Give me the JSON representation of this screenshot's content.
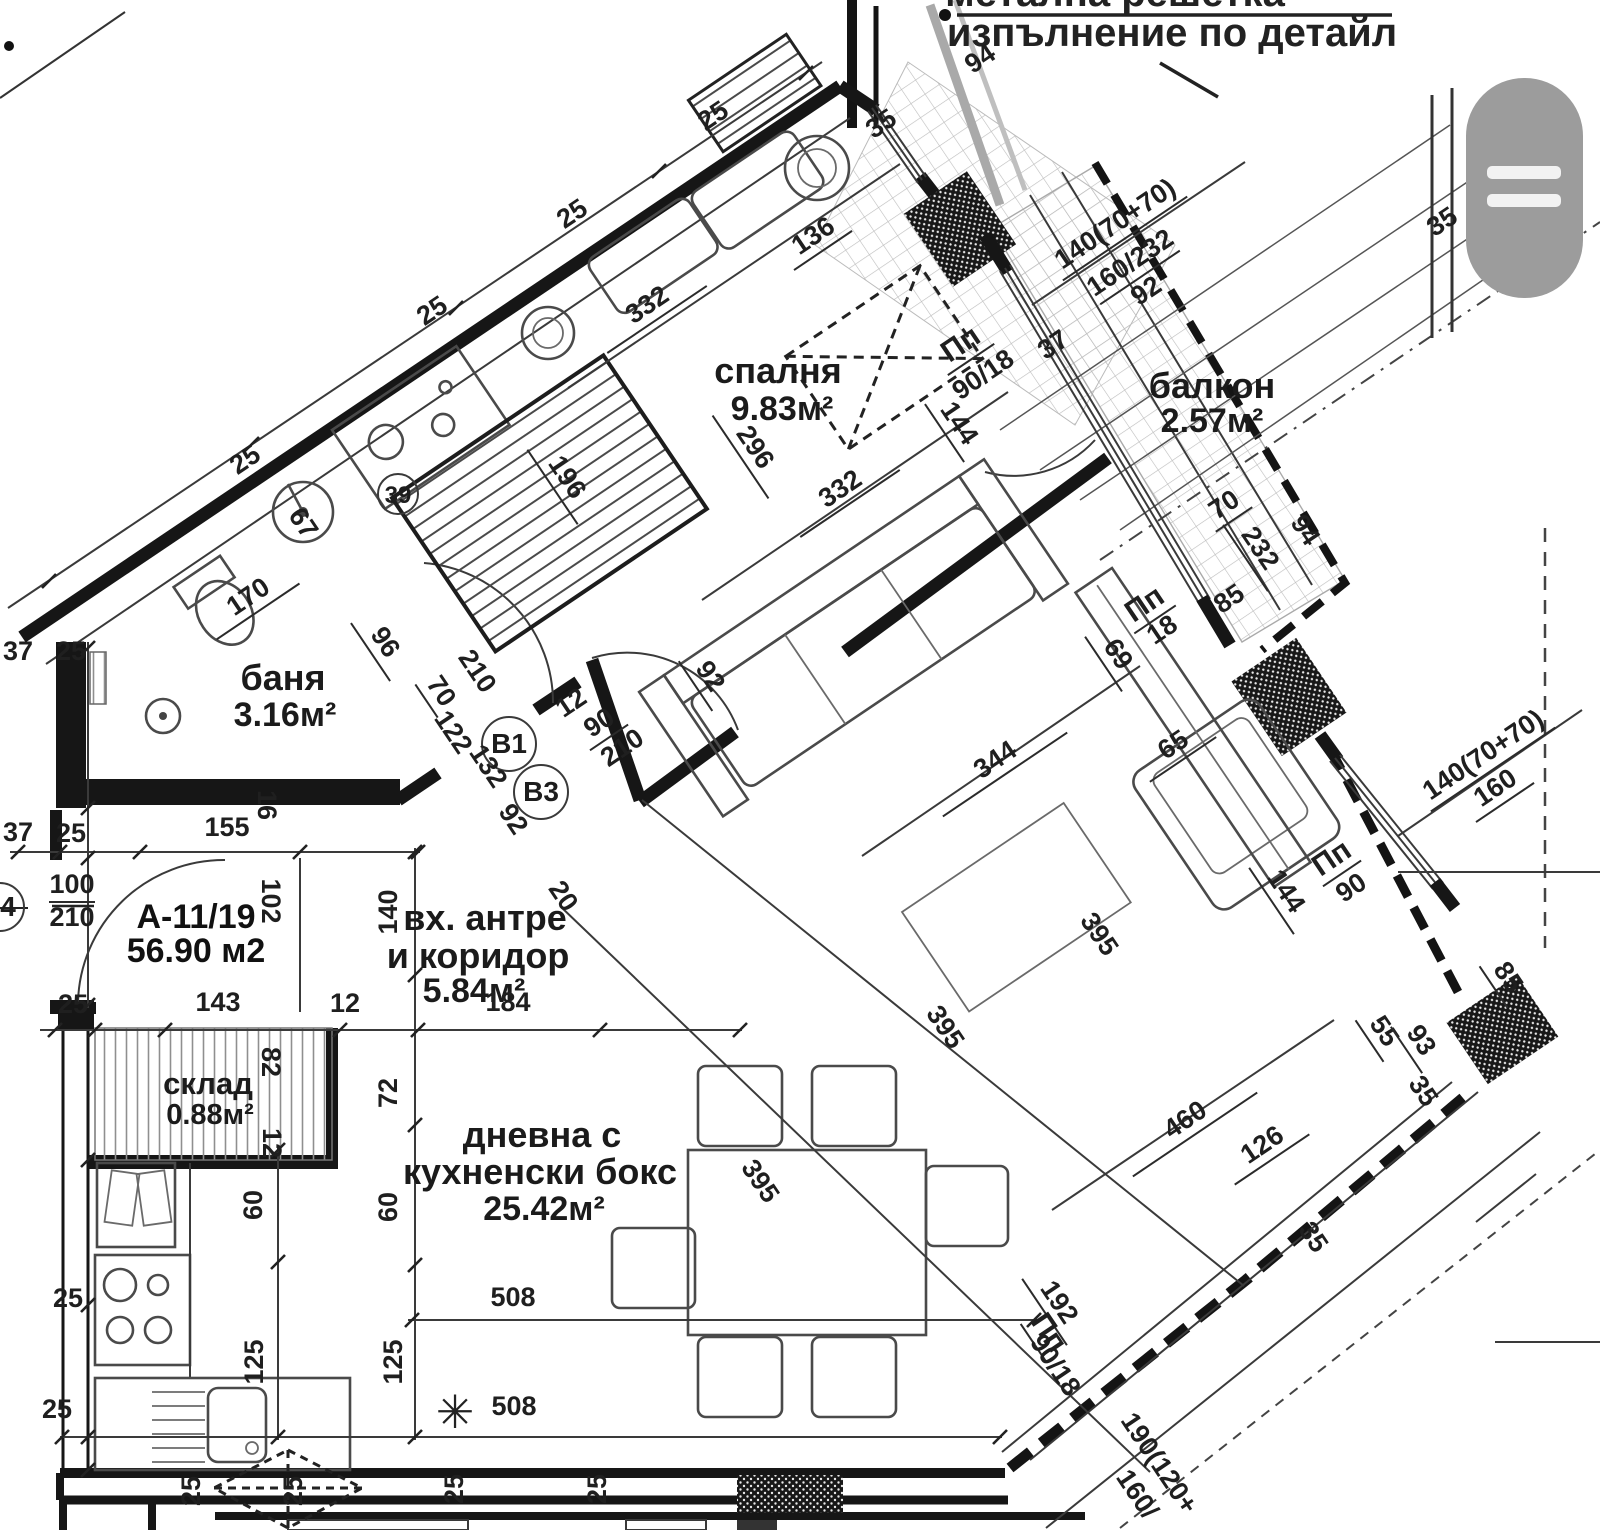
{
  "annotation": {
    "line1": "метална решетка",
    "line2": "изпълнение по детайл"
  },
  "apartment": {
    "id": "А-11/19",
    "area_label": "56.90 м2"
  },
  "rooms": [
    {
      "name": "спалня",
      "area": "9.83м²"
    },
    {
      "name": "балкон",
      "area": "2.57м²"
    },
    {
      "name": "баня",
      "area": "3.16м²"
    },
    {
      "name": "вх. антре",
      "name2": "и коридор",
      "area": "5.84м²"
    },
    {
      "name": "склад",
      "area": "0.88м²"
    },
    {
      "name": "дневна с",
      "name2": "кухненски бокс",
      "area": "25.42м²"
    }
  ],
  "markers": [
    {
      "t": "В1"
    },
    {
      "t": "В3"
    },
    {
      "t": "4"
    },
    {
      "t": "39"
    }
  ],
  "symbols": {
    "asterisk": "✳",
    "menu_icon": "hamburger-menu-icon"
  },
  "colors": {
    "line": "#1b1b1b",
    "menu_gray": "#9c9c9c",
    "paper": "#ffffff"
  },
  "labels": [
    {
      "t": "94",
      "x": 985,
      "y": 66,
      "r": -34
    },
    {
      "t": "25",
      "x": 718,
      "y": 123,
      "r": -34
    },
    {
      "t": "25",
      "x": 577,
      "y": 221,
      "r": -34
    },
    {
      "t": "25",
      "x": 437,
      "y": 318,
      "r": -34
    },
    {
      "t": "25",
      "x": 250,
      "y": 467,
      "r": -34
    },
    {
      "t": "35",
      "x": 886,
      "y": 131,
      "r": -34
    },
    {
      "t": "136",
      "x": 818,
      "y": 243,
      "r": -34,
      "ln": 70
    },
    {
      "t": "332",
      "x": 652,
      "y": 312,
      "r": -34,
      "ln": 120
    },
    {
      "t": "332",
      "x": 845,
      "y": 496,
      "r": -34,
      "ln": 120
    },
    {
      "t": "296",
      "x": 748,
      "y": 452,
      "r": 56,
      "ln": 100
    },
    {
      "t": "196",
      "x": 560,
      "y": 482,
      "r": 56,
      "ln": 90
    },
    {
      "t": "144",
      "x": 952,
      "y": 428,
      "r": 56,
      "ln": 70
    },
    {
      "t": "Пп",
      "x": 966,
      "y": 352,
      "r": -34,
      "fs": 30,
      "ln": 56
    },
    {
      "t": "90/18",
      "x": 988,
      "y": 382,
      "r": -34
    },
    {
      "t": "35",
      "x": 1447,
      "y": 229,
      "r": -34
    },
    {
      "t": "140(70+70)",
      "x": 1120,
      "y": 231,
      "r": -34,
      "ln": 150
    },
    {
      "t": "160/232",
      "x": 1135,
      "y": 270,
      "r": -34,
      "ln": 96
    },
    {
      "t": "92",
      "x": 1151,
      "y": 298,
      "r": -34
    },
    {
      "t": "37",
      "x": 1058,
      "y": 352,
      "r": -34
    },
    {
      "t": "70",
      "x": 1229,
      "y": 512,
      "r": -34,
      "ln": 44
    },
    {
      "t": "232",
      "x": 1253,
      "y": 553,
      "r": 56,
      "ln": 80
    },
    {
      "t": "94",
      "x": 1298,
      "y": 535,
      "r": 56
    },
    {
      "t": "Пп",
      "x": 1150,
      "y": 612,
      "r": -34,
      "fs": 30,
      "ln": 50
    },
    {
      "t": "18",
      "x": 1167,
      "y": 637,
      "r": -34
    },
    {
      "t": "85",
      "x": 1234,
      "y": 606,
      "r": -34
    },
    {
      "t": "69",
      "x": 1111,
      "y": 659,
      "r": 56,
      "ln": 66
    },
    {
      "t": "344",
      "x": 1000,
      "y": 767,
      "r": -34,
      "ln": 150
    },
    {
      "t": "65",
      "x": 1178,
      "y": 752,
      "r": -34,
      "ln": 80
    },
    {
      "t": "144",
      "x": 1279,
      "y": 896,
      "r": 56,
      "ln": 80
    },
    {
      "t": "Пп",
      "x": 1337,
      "y": 866,
      "r": -34,
      "fs": 30,
      "ln": 46
    },
    {
      "t": "90",
      "x": 1356,
      "y": 895,
      "r": -34
    },
    {
      "t": "140(70+70)",
      "x": 1488,
      "y": 762,
      "r": -34,
      "ln": 150
    },
    {
      "t": "160",
      "x": 1500,
      "y": 795,
      "r": -34,
      "ln": 70
    },
    {
      "t": "85",
      "x": 1501,
      "y": 982,
      "r": 56,
      "ln": 50
    },
    {
      "t": "170",
      "x": 253,
      "y": 604,
      "r": -34,
      "ln": 100
    },
    {
      "t": "96",
      "x": 378,
      "y": 647,
      "r": 56,
      "ln": 70
    },
    {
      "t": "70",
      "x": 434,
      "y": 696,
      "r": 56,
      "ln": 40
    },
    {
      "t": "210",
      "x": 470,
      "y": 676,
      "r": 56
    },
    {
      "t": "122",
      "x": 446,
      "y": 737,
      "r": 56
    },
    {
      "t": "132",
      "x": 481,
      "y": 771,
      "r": 56
    },
    {
      "t": "92",
      "x": 506,
      "y": 824,
      "r": 56
    },
    {
      "t": "12",
      "x": 576,
      "y": 710,
      "r": -34
    },
    {
      "t": "90",
      "x": 604,
      "y": 730,
      "r": -34,
      "ln": 46
    },
    {
      "t": "210",
      "x": 627,
      "y": 755,
      "r": -34
    },
    {
      "t": "92",
      "x": 703,
      "y": 681,
      "r": 56,
      "ln": 60
    },
    {
      "t": "20",
      "x": 556,
      "y": 901,
      "r": 56
    },
    {
      "t": "155",
      "x": 227,
      "y": 836
    },
    {
      "t": "16",
      "x": 258,
      "y": 805,
      "r": 90
    },
    {
      "t": "37",
      "x": 18,
      "y": 660
    },
    {
      "t": "25",
      "x": 71,
      "y": 660
    },
    {
      "t": "37",
      "x": 18,
      "y": 841
    },
    {
      "t": "25",
      "x": 71,
      "y": 842
    },
    {
      "t": "100",
      "x": 72,
      "y": 893,
      "ln": 46
    },
    {
      "t": "210",
      "x": 72,
      "y": 926
    },
    {
      "t": "102",
      "x": 262,
      "y": 901,
      "r": 90
    },
    {
      "t": "25",
      "x": 73,
      "y": 1013
    },
    {
      "t": "143",
      "x": 218,
      "y": 1011
    },
    {
      "t": "12",
      "x": 345,
      "y": 1012
    },
    {
      "t": "82",
      "x": 262,
      "y": 1062,
      "r": 90
    },
    {
      "t": "12",
      "x": 263,
      "y": 1143,
      "r": 90
    },
    {
      "t": "140",
      "x": 397,
      "y": 912,
      "r": -90
    },
    {
      "t": "72",
      "x": 397,
      "y": 1093,
      "r": -90
    },
    {
      "t": "60",
      "x": 262,
      "y": 1205,
      "r": -90
    },
    {
      "t": "60",
      "x": 397,
      "y": 1207,
      "r": -90
    },
    {
      "t": "125",
      "x": 263,
      "y": 1362,
      "r": -90
    },
    {
      "t": "125",
      "x": 402,
      "y": 1362,
      "r": -90
    },
    {
      "t": "184",
      "x": 508,
      "y": 1011
    },
    {
      "t": "508",
      "x": 513,
      "y": 1306
    },
    {
      "t": "508",
      "x": 514,
      "y": 1415
    },
    {
      "t": "25",
      "x": 68,
      "y": 1307
    },
    {
      "t": "25",
      "x": 57,
      "y": 1418
    },
    {
      "t": "25",
      "x": 200,
      "y": 1491,
      "r": -90
    },
    {
      "t": "25",
      "x": 302,
      "y": 1491,
      "r": -90
    },
    {
      "t": "25",
      "x": 463,
      "y": 1489,
      "r": -90
    },
    {
      "t": "25",
      "x": 606,
      "y": 1489,
      "r": -90
    },
    {
      "t": "395",
      "x": 1092,
      "y": 939,
      "r": 56
    },
    {
      "t": "395",
      "x": 938,
      "y": 1032,
      "r": 56
    },
    {
      "t": "395",
      "x": 753,
      "y": 1186,
      "r": 56
    },
    {
      "t": "460",
      "x": 1190,
      "y": 1127,
      "r": -34,
      "ln": 150
    },
    {
      "t": "126",
      "x": 1267,
      "y": 1152,
      "r": -34,
      "ln": 90
    },
    {
      "t": "55",
      "x": 1377,
      "y": 1036,
      "r": 56,
      "ln": 50
    },
    {
      "t": "93",
      "x": 1414,
      "y": 1045,
      "r": 56,
      "ln": 56
    },
    {
      "t": "35",
      "x": 1416,
      "y": 1096,
      "r": 56
    },
    {
      "t": "35",
      "x": 1306,
      "y": 1242,
      "r": 56
    },
    {
      "t": "192",
      "x": 1052,
      "y": 1307,
      "r": 56,
      "ln": 80
    },
    {
      "t": "Пп",
      "x": 1041,
      "y": 1338,
      "r": 56,
      "fs": 30,
      "ln": 46
    },
    {
      "t": "90/18",
      "x": 1048,
      "y": 1370,
      "r": 56
    },
    {
      "t": "190(120+",
      "x": 1152,
      "y": 1468,
      "r": 56
    },
    {
      "t": "160/",
      "x": 1130,
      "y": 1499,
      "r": 56
    },
    {
      "t": "67",
      "x": 296,
      "y": 528,
      "r": 56
    }
  ]
}
